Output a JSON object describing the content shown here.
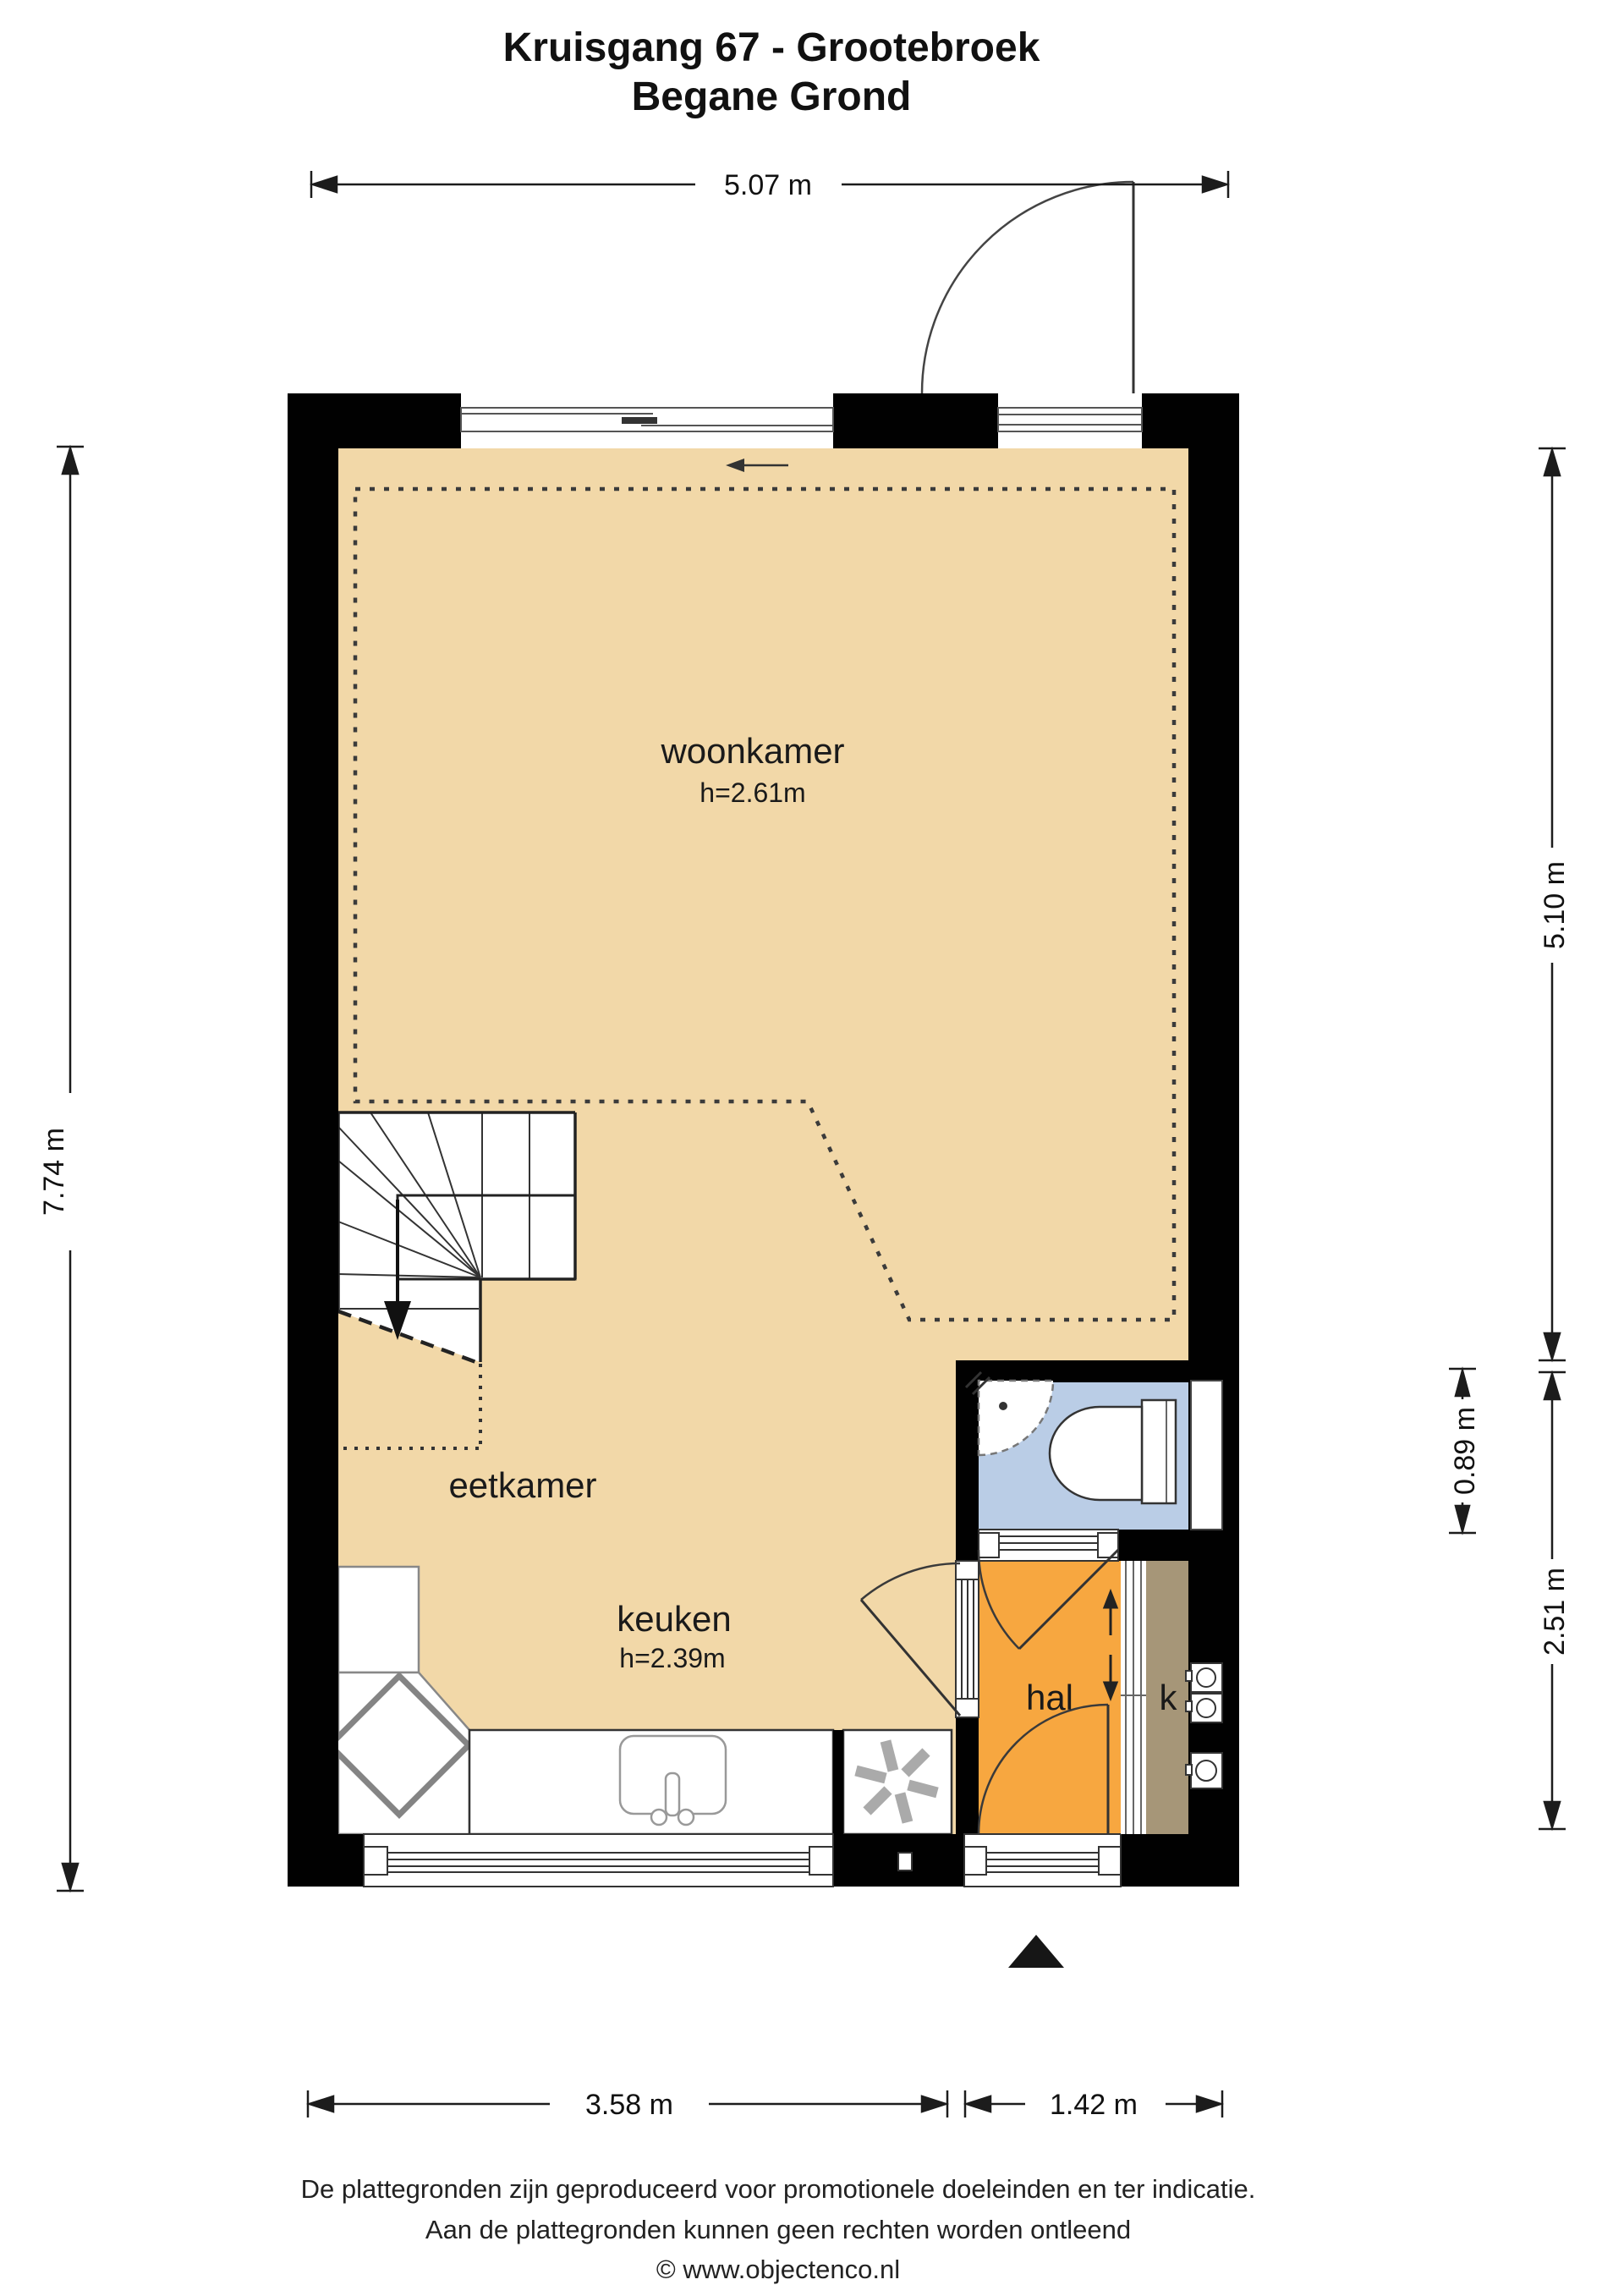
{
  "title": {
    "line1": "Kruisgang 67 - Grootebroek",
    "line2": "Begane Grond"
  },
  "rooms": {
    "woonkamer": {
      "label": "woonkamer",
      "height": "h=2.61m"
    },
    "eetkamer": {
      "label": "eetkamer"
    },
    "keuken": {
      "label": "keuken",
      "height": "h=2.39m"
    },
    "hal": {
      "label": "hal"
    },
    "kast": {
      "label": "k"
    }
  },
  "dims": {
    "top": "5.07 m",
    "left": "7.74 m",
    "right_upper": "5.10 m",
    "right_bath": "0.89 m",
    "right_lower": "2.51 m",
    "bottom_left": "3.58 m",
    "bottom_right": "1.42 m"
  },
  "colors": {
    "floor": "#F2D8A8",
    "hall": "#F7A740",
    "bath": "#BACDE6",
    "closet": "#A69678",
    "wall": "#010101"
  },
  "footer": {
    "line1": "De plattegronden zijn geproduceerd voor promotionele doeleinden en ter indicatie.",
    "line2": "Aan de plattegronden kunnen geen rechten worden ontleend",
    "line3": "© www.objectenco.nl"
  }
}
